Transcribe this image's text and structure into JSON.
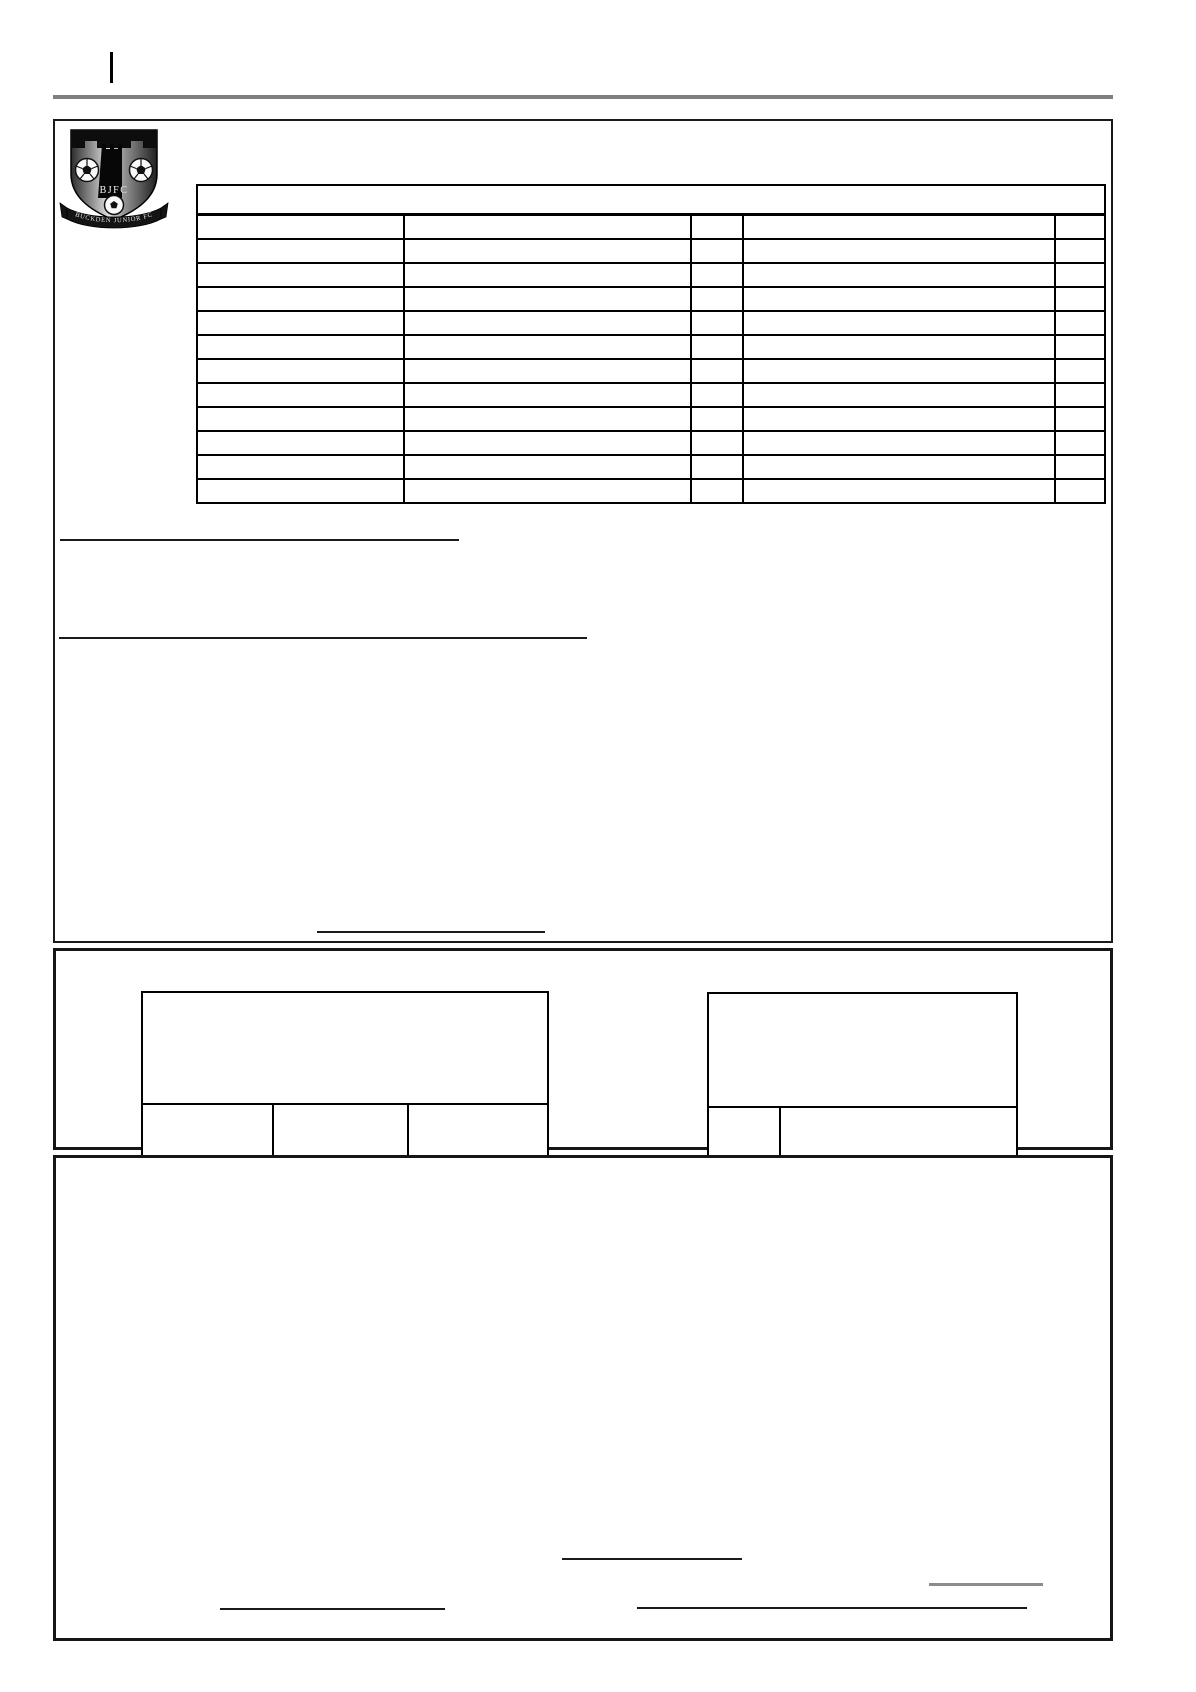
{
  "document": {
    "kind": "blank club form page",
    "crest": {
      "initials": "BJFC",
      "banner_text": "BUCKDEN JUNIOR FC"
    }
  },
  "colors": {
    "divider_gray": "#7f7f7f",
    "ink_black": "#1a1a1a",
    "gray_signature_line": "#8c8c8c"
  },
  "form": {
    "main_table": {
      "title": "",
      "rows": [
        [
          "",
          "",
          "",
          "",
          ""
        ],
        [
          "",
          "",
          "",
          "",
          ""
        ],
        [
          "",
          "",
          "",
          "",
          ""
        ],
        [
          "",
          "",
          "",
          "",
          ""
        ],
        [
          "",
          "",
          "",
          "",
          ""
        ],
        [
          "",
          "",
          "",
          "",
          ""
        ],
        [
          "",
          "",
          "",
          "",
          ""
        ],
        [
          "",
          "",
          "",
          "",
          ""
        ],
        [
          "",
          "",
          "",
          "",
          ""
        ],
        [
          "",
          "",
          "",
          "",
          ""
        ],
        [
          "",
          "",
          "",
          "",
          ""
        ],
        [
          "",
          "",
          "",
          "",
          ""
        ]
      ]
    },
    "left_table": {
      "title": "",
      "row": [
        "",
        "",
        ""
      ]
    },
    "right_table": {
      "title": "",
      "row": [
        "",
        ""
      ]
    }
  }
}
